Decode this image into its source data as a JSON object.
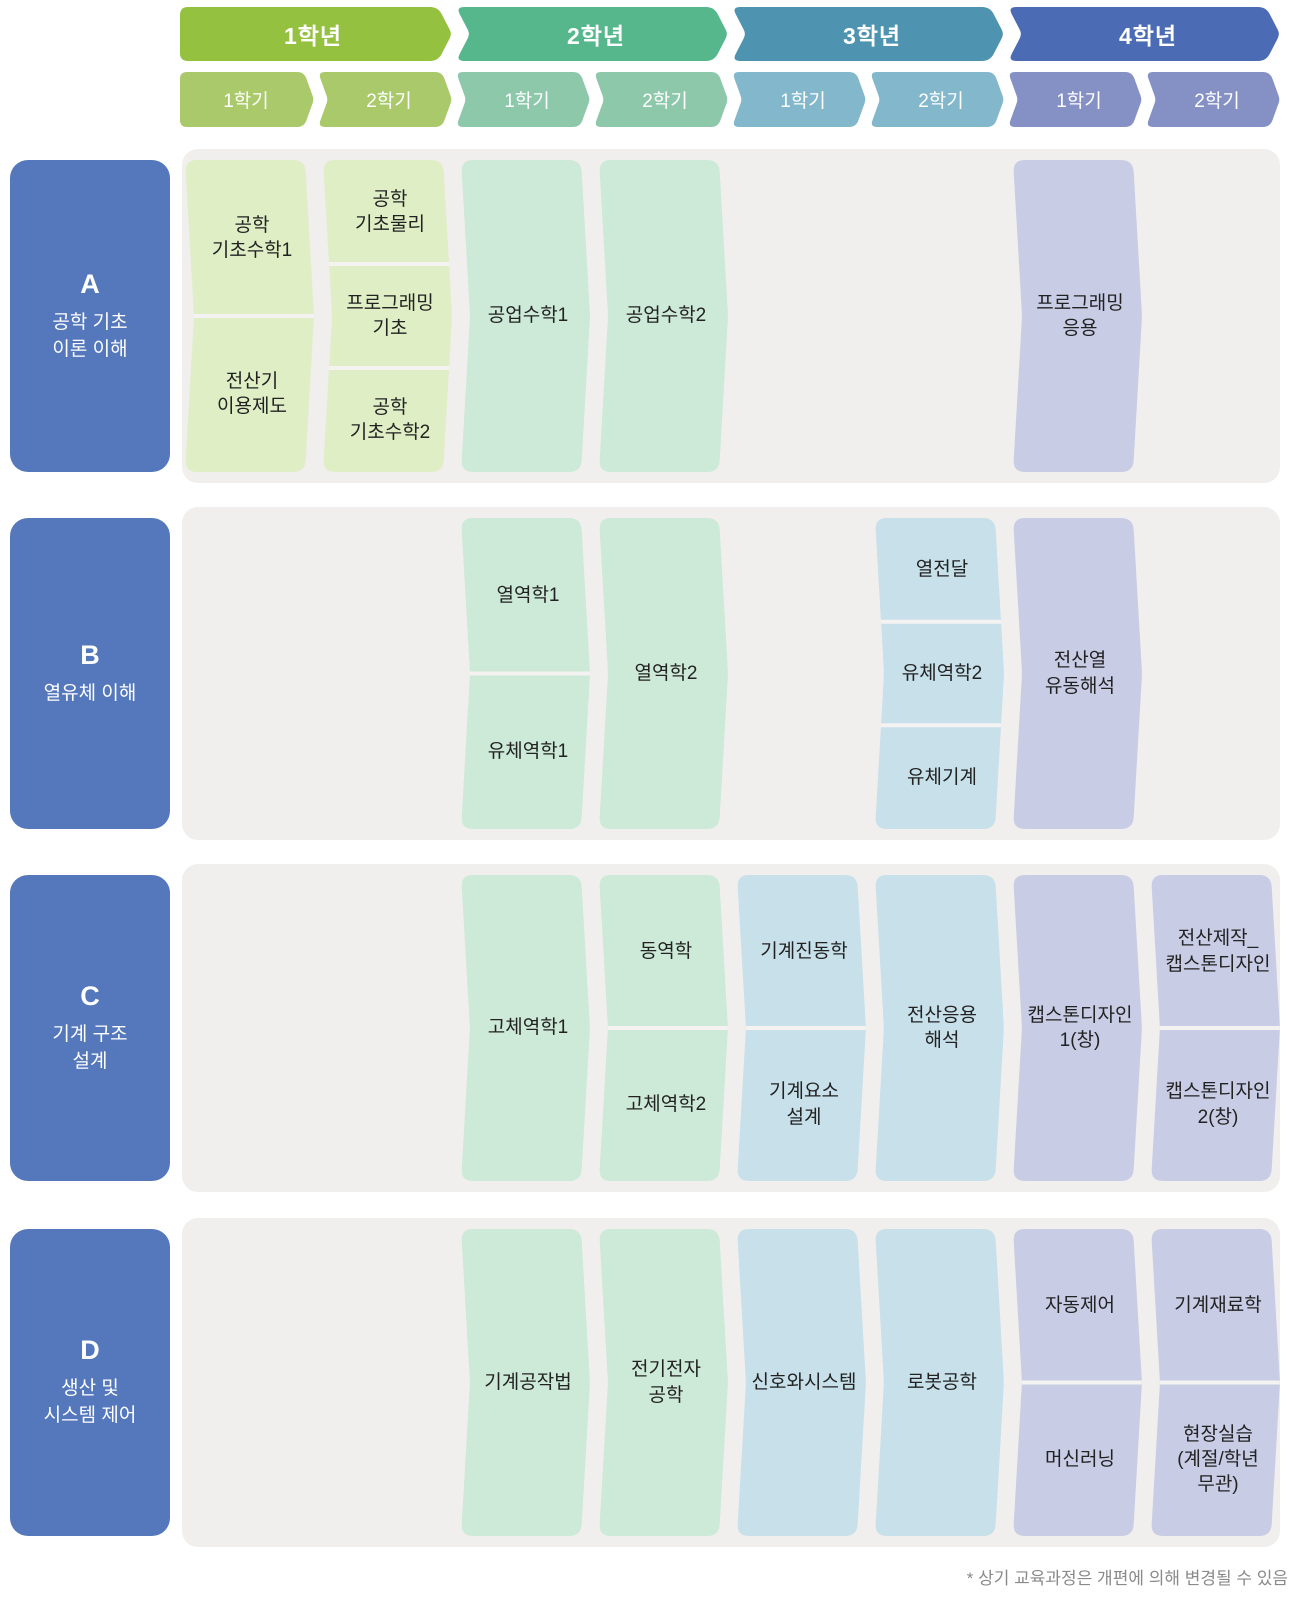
{
  "page": {
    "footnote": "* 상기 교육과정은 개편에 의해 변경될 수 있음"
  },
  "colors": {
    "year_headers": [
      "#95c140",
      "#57b78c",
      "#4e93b0",
      "#4b6cb4"
    ],
    "semester_headers": [
      "#a9c96b",
      "#8ec8ab",
      "#83b7cb",
      "#8591c5"
    ],
    "course_blocks": [
      "#dfeec5",
      "#cde9d7",
      "#c7e0ea",
      "#c8cce5"
    ],
    "category_box": "#5478bb",
    "row_background": "#f0efed",
    "cell_separator": "#f4f3f1",
    "course_text": "#222222",
    "footnote_text": "#8a8a8a"
  },
  "header": {
    "years": [
      {
        "label": "1학년",
        "semesters": [
          "1학기",
          "2학기"
        ]
      },
      {
        "label": "2학년",
        "semesters": [
          "1학기",
          "2학기"
        ]
      },
      {
        "label": "3학년",
        "semesters": [
          "1학기",
          "2학기"
        ]
      },
      {
        "label": "4학년",
        "semesters": [
          "1학기",
          "2학기"
        ]
      }
    ]
  },
  "tracks": [
    {
      "letter": "A",
      "title": "공학 기초\n이론 이해",
      "courses": [
        {
          "year": 1,
          "semester": 1,
          "cells": [
            "공학\n기초수학1",
            "전산기\n이용제도"
          ]
        },
        {
          "year": 1,
          "semester": 2,
          "cells": [
            "공학\n기초물리",
            "프로그래밍\n기초",
            "공학\n기초수학2"
          ]
        },
        {
          "year": 2,
          "semester": 1,
          "cells": [
            "공업수학1"
          ]
        },
        {
          "year": 2,
          "semester": 2,
          "cells": [
            "공업수학2"
          ]
        },
        {
          "year": 4,
          "semester": 1,
          "cells": [
            "프로그래밍\n응용"
          ]
        }
      ]
    },
    {
      "letter": "B",
      "title": "열유체 이해",
      "courses": [
        {
          "year": 2,
          "semester": 1,
          "cells": [
            "열역학1",
            "유체역학1"
          ]
        },
        {
          "year": 2,
          "semester": 2,
          "cells": [
            "열역학2"
          ]
        },
        {
          "year": 3,
          "semester": 2,
          "cells": [
            "열전달",
            "유체역학2",
            "유체기계"
          ]
        },
        {
          "year": 4,
          "semester": 1,
          "cells": [
            "전산열\n유동해석"
          ]
        }
      ]
    },
    {
      "letter": "C",
      "title": "기계 구조\n설계",
      "courses": [
        {
          "year": 2,
          "semester": 1,
          "cells": [
            "고체역학1"
          ]
        },
        {
          "year": 2,
          "semester": 2,
          "cells": [
            "동역학",
            "고체역학2"
          ]
        },
        {
          "year": 3,
          "semester": 1,
          "cells": [
            "기계진동학",
            "기계요소\n설계"
          ]
        },
        {
          "year": 3,
          "semester": 2,
          "cells": [
            "전산응용\n해석"
          ]
        },
        {
          "year": 4,
          "semester": 1,
          "cells": [
            "캡스톤디자인\n1(창)"
          ]
        },
        {
          "year": 4,
          "semester": 2,
          "cells": [
            "전산제작_\n캡스톤디자인",
            "캡스톤디자인\n2(창)"
          ]
        }
      ]
    },
    {
      "letter": "D",
      "title": "생산 및\n시스템 제어",
      "courses": [
        {
          "year": 2,
          "semester": 1,
          "cells": [
            "기계공작법"
          ]
        },
        {
          "year": 2,
          "semester": 2,
          "cells": [
            "전기전자\n공학"
          ]
        },
        {
          "year": 3,
          "semester": 1,
          "cells": [
            "신호와시스템"
          ]
        },
        {
          "year": 3,
          "semester": 2,
          "cells": [
            "로봇공학"
          ]
        },
        {
          "year": 4,
          "semester": 1,
          "cells": [
            "자동제어",
            "머신러닝"
          ]
        },
        {
          "year": 4,
          "semester": 2,
          "cells": [
            "기계재료학",
            "현장실습\n(계절/학년\n무관)"
          ]
        }
      ]
    }
  ]
}
